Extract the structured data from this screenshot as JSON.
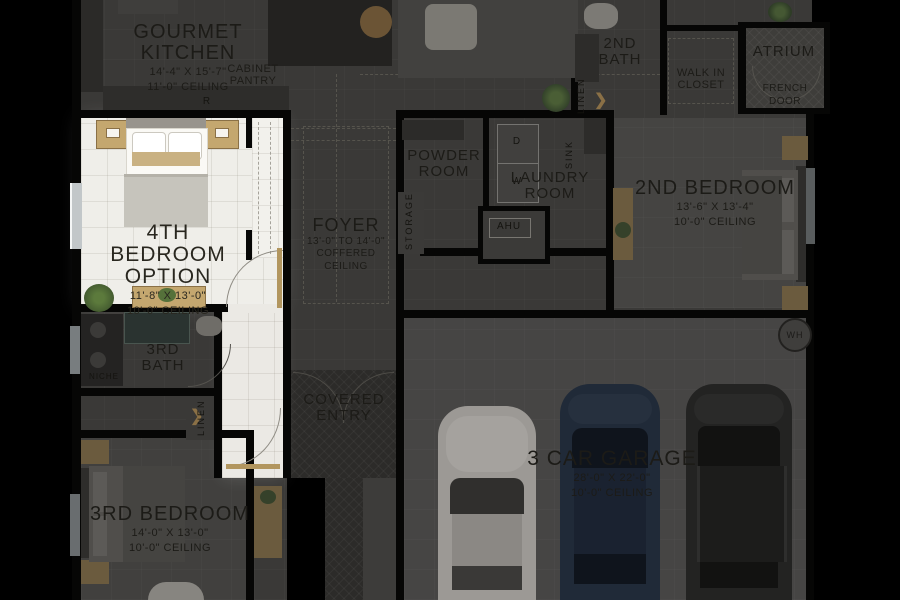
{
  "plan_title": "Floor plan — 4th Bedroom Option highlighted",
  "colors": {
    "background": "#000000",
    "floor_dim": "#3a3937",
    "floor_garage": "#464544",
    "wall": "#060605",
    "highlight_floor": "#efeee9",
    "accent_wood": "#c4a76f",
    "accent_wood_dim": "#6b5b3e",
    "label_dim": "#1c1b17",
    "label_bright": "#29271f",
    "car_white": "#9c9995",
    "car_navy": "#202a38",
    "car_dark": "#232322"
  },
  "rooms": {
    "gourmet_kitchen": {
      "lines": [
        "GOURMET KITCHEN",
        "14'-4\" X 15'-7\"",
        "11'-0\" CEILING"
      ]
    },
    "cabinet_pantry": {
      "lines": [
        "CABINET",
        "PANTRY"
      ]
    },
    "second_bath": {
      "lines": [
        "2ND",
        "BATH"
      ]
    },
    "walk_in_closet": {
      "lines": [
        "WALK IN",
        "CLOSET"
      ]
    },
    "atrium": {
      "lines": [
        "ATRIUM"
      ]
    },
    "french_door": {
      "lines": [
        "FRENCH",
        "DOOR"
      ]
    },
    "powder_room": {
      "lines": [
        "POWDER",
        "ROOM"
      ]
    },
    "laundry_room": {
      "lines": [
        "LAUNDRY",
        "ROOM"
      ]
    },
    "second_bedroom": {
      "lines": [
        "2ND BEDROOM",
        "13'-6\" X 13'-4\"",
        "10'-0\" CEILING"
      ]
    },
    "fourth_bedroom_option": {
      "lines": [
        "4TH BEDROOM",
        "OPTION",
        "11'-8\" X 13'-0\"",
        "10'-0\" CEILING"
      ],
      "highlighted": true
    },
    "foyer": {
      "lines": [
        "FOYER",
        "13'-0\" TO 14'-0\"",
        "COFFERED",
        "CEILING"
      ]
    },
    "third_bath": {
      "lines": [
        "3RD",
        "BATH"
      ]
    },
    "covered_entry": {
      "lines": [
        "COVERED",
        "ENTRY"
      ]
    },
    "third_bedroom": {
      "lines": [
        "3RD BEDROOM",
        "14'-0\" X 13'-0\"",
        "10'-0\" CEILING"
      ]
    },
    "garage": {
      "lines": [
        "3 CAR GARAGE",
        "28'-0\" X 22'-0\"",
        "10'-0\" CEILING"
      ]
    }
  },
  "markers": {
    "refrigerator": "R",
    "dryer": "D",
    "washer": "W",
    "sink": "SINK",
    "linen_bath2": "LINEN",
    "linen_hall": "LINEN",
    "niche": "NICHE",
    "storage": "STORAGE",
    "ahu": "AHU",
    "water_heater": "WH"
  }
}
